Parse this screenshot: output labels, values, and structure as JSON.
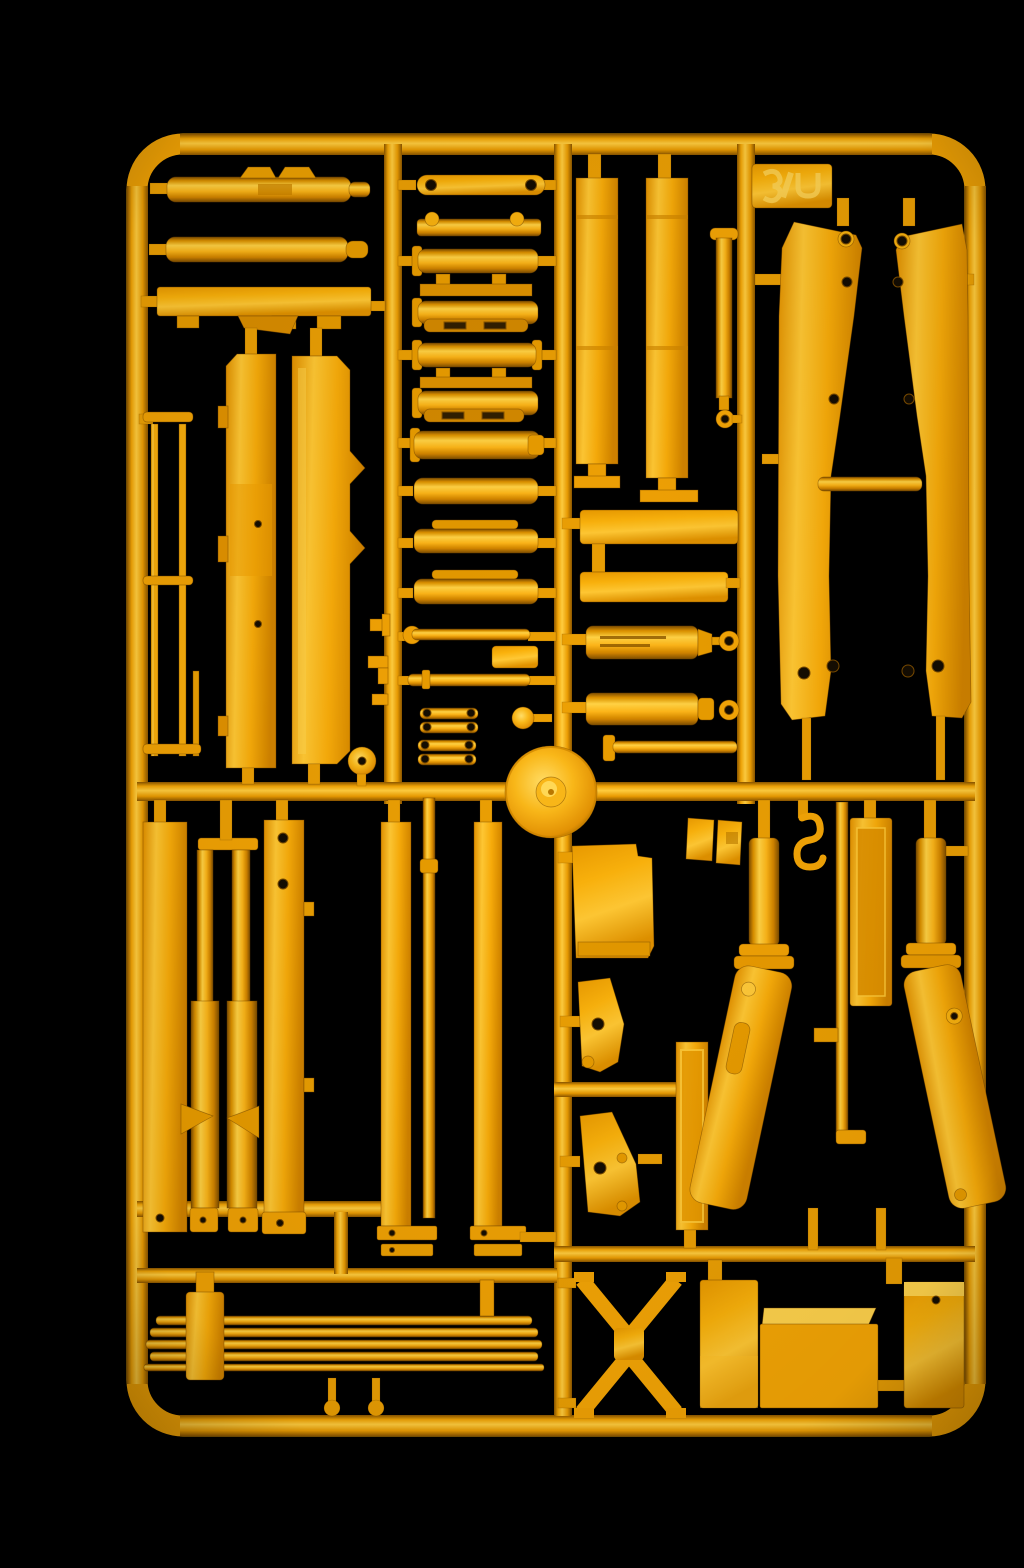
{
  "scene": {
    "description": "Photograph of a yellow injection-moulded model kit sprue (runner frame) holding crane and construction-vehicle parts, shot against a black background",
    "alt": "Yellow plastic model kit sprue with hydraulic cylinders, boom side panels, outrigger legs, cable drum and leaf spring parts on black",
    "background_color": "#000000"
  },
  "palette": {
    "background": "#000000",
    "plastic_base": "#F5A90E",
    "plastic_highlight": "#FFD44F",
    "plastic_midtone": "#F1A007",
    "plastic_shadow": "#C17C00",
    "plastic_deep_shadow": "#8A5600",
    "hole_color": "#140D02"
  },
  "sprue": {
    "material": "yellow styrene plastic",
    "orientation": "portrait rectangular frame with rounded corners",
    "tag": {
      "present": true,
      "location": "top-right",
      "embossed_marks": 3,
      "text_legible": false
    },
    "parts": [
      {
        "id": "hydraulic-cylinder-1",
        "label": "Hydraulic cylinder with top clamps"
      },
      {
        "id": "hydraulic-cylinder-2",
        "label": "Hydraulic cylinder with end cap"
      },
      {
        "id": "notched-beam",
        "label": "Long beam with notched underside"
      },
      {
        "id": "boom-panel-a",
        "label": "Tall boom panel, chamfered corner, two holes"
      },
      {
        "id": "boom-panel-b",
        "label": "Tall boom panel with stepped right edge"
      },
      {
        "id": "ladder-rails",
        "label": "Thin ladder rails with rungs"
      },
      {
        "id": "small-pulley",
        "label": "Small pulley disc"
      },
      {
        "id": "eye-strap",
        "label": "Flat link strap with eye holes"
      },
      {
        "id": "boss-bar",
        "label": "Bar with two round bosses"
      },
      {
        "id": "piston-cylinders",
        "label": "Stack of flanged piston cylinders",
        "count": 8
      },
      {
        "id": "slotted-straps",
        "label": "Thin slotted link straps",
        "count": 3
      },
      {
        "id": "tie-rods",
        "label": "Thin tie rods with collar",
        "count": 2
      },
      {
        "id": "link-pairs",
        "label": "Paired small link straps with eyes",
        "count": 2
      },
      {
        "id": "knob",
        "label": "Round knob"
      },
      {
        "id": "cable-drum",
        "label": "Large cable drum disc with conical hub"
      },
      {
        "id": "mast-panel-c",
        "label": "Narrow vertical mast panel with seams"
      },
      {
        "id": "mast-panel-d",
        "label": "Narrow vertical mast panel with seams"
      },
      {
        "id": "thin-cylinder-eye",
        "label": "Thin cylinder with eye ring"
      },
      {
        "id": "flat-bars",
        "label": "Two flat horizontal bars",
        "count": 2
      },
      {
        "id": "detailed-cylinders",
        "label": "Slotted cylinders with eye rings",
        "count": 2
      },
      {
        "id": "flanged-rod",
        "label": "Rod with end flange"
      },
      {
        "id": "boom-side-left",
        "label": "Large boom side plate, waisted, five holes"
      },
      {
        "id": "boom-side-right",
        "label": "Large boom side plate, mirrored"
      },
      {
        "id": "boom-crossbar",
        "label": "Cross bar between boom plates"
      },
      {
        "id": "chassis-strip-1",
        "label": "Long chassis strip with bottom hole"
      },
      {
        "id": "vertical-cylinders",
        "label": "Vertical cylinders with wedge collars",
        "count": 2
      },
      {
        "id": "chassis-panel-e",
        "label": "Chassis panel with two holes and side tabs"
      },
      {
        "id": "frame-strips",
        "label": "Long frame strips with bracket feet",
        "count": 2
      },
      {
        "id": "center-rod",
        "label": "Long thin rod with collar"
      },
      {
        "id": "cab-plate",
        "label": "Cab box plate with corner notch"
      },
      {
        "id": "angle-brackets",
        "label": "Small angle brackets",
        "count": 2
      },
      {
        "id": "triangular-brackets",
        "label": "Triangular gusset plates with holes",
        "count": 2
      },
      {
        "id": "inset-panel",
        "label": "Narrow panel with inset border"
      },
      {
        "id": "hook",
        "label": "Small crane hook"
      },
      {
        "id": "outrigger-leg-left",
        "label": "Outrigger leg with collar flanges, slanted"
      },
      {
        "id": "outrigger-leg-right",
        "label": "Outrigger leg, mirrored"
      },
      {
        "id": "x-brace",
        "label": "X-shaped cross brace"
      },
      {
        "id": "engine-box-1",
        "label": "Tall equipment box"
      },
      {
        "id": "engine-box-2",
        "label": "Large engine box with top face"
      },
      {
        "id": "engine-box-3",
        "label": "Small box with pin hole"
      },
      {
        "id": "leaf-spring",
        "label": "Leaf spring stack with centre clamp"
      }
    ]
  }
}
